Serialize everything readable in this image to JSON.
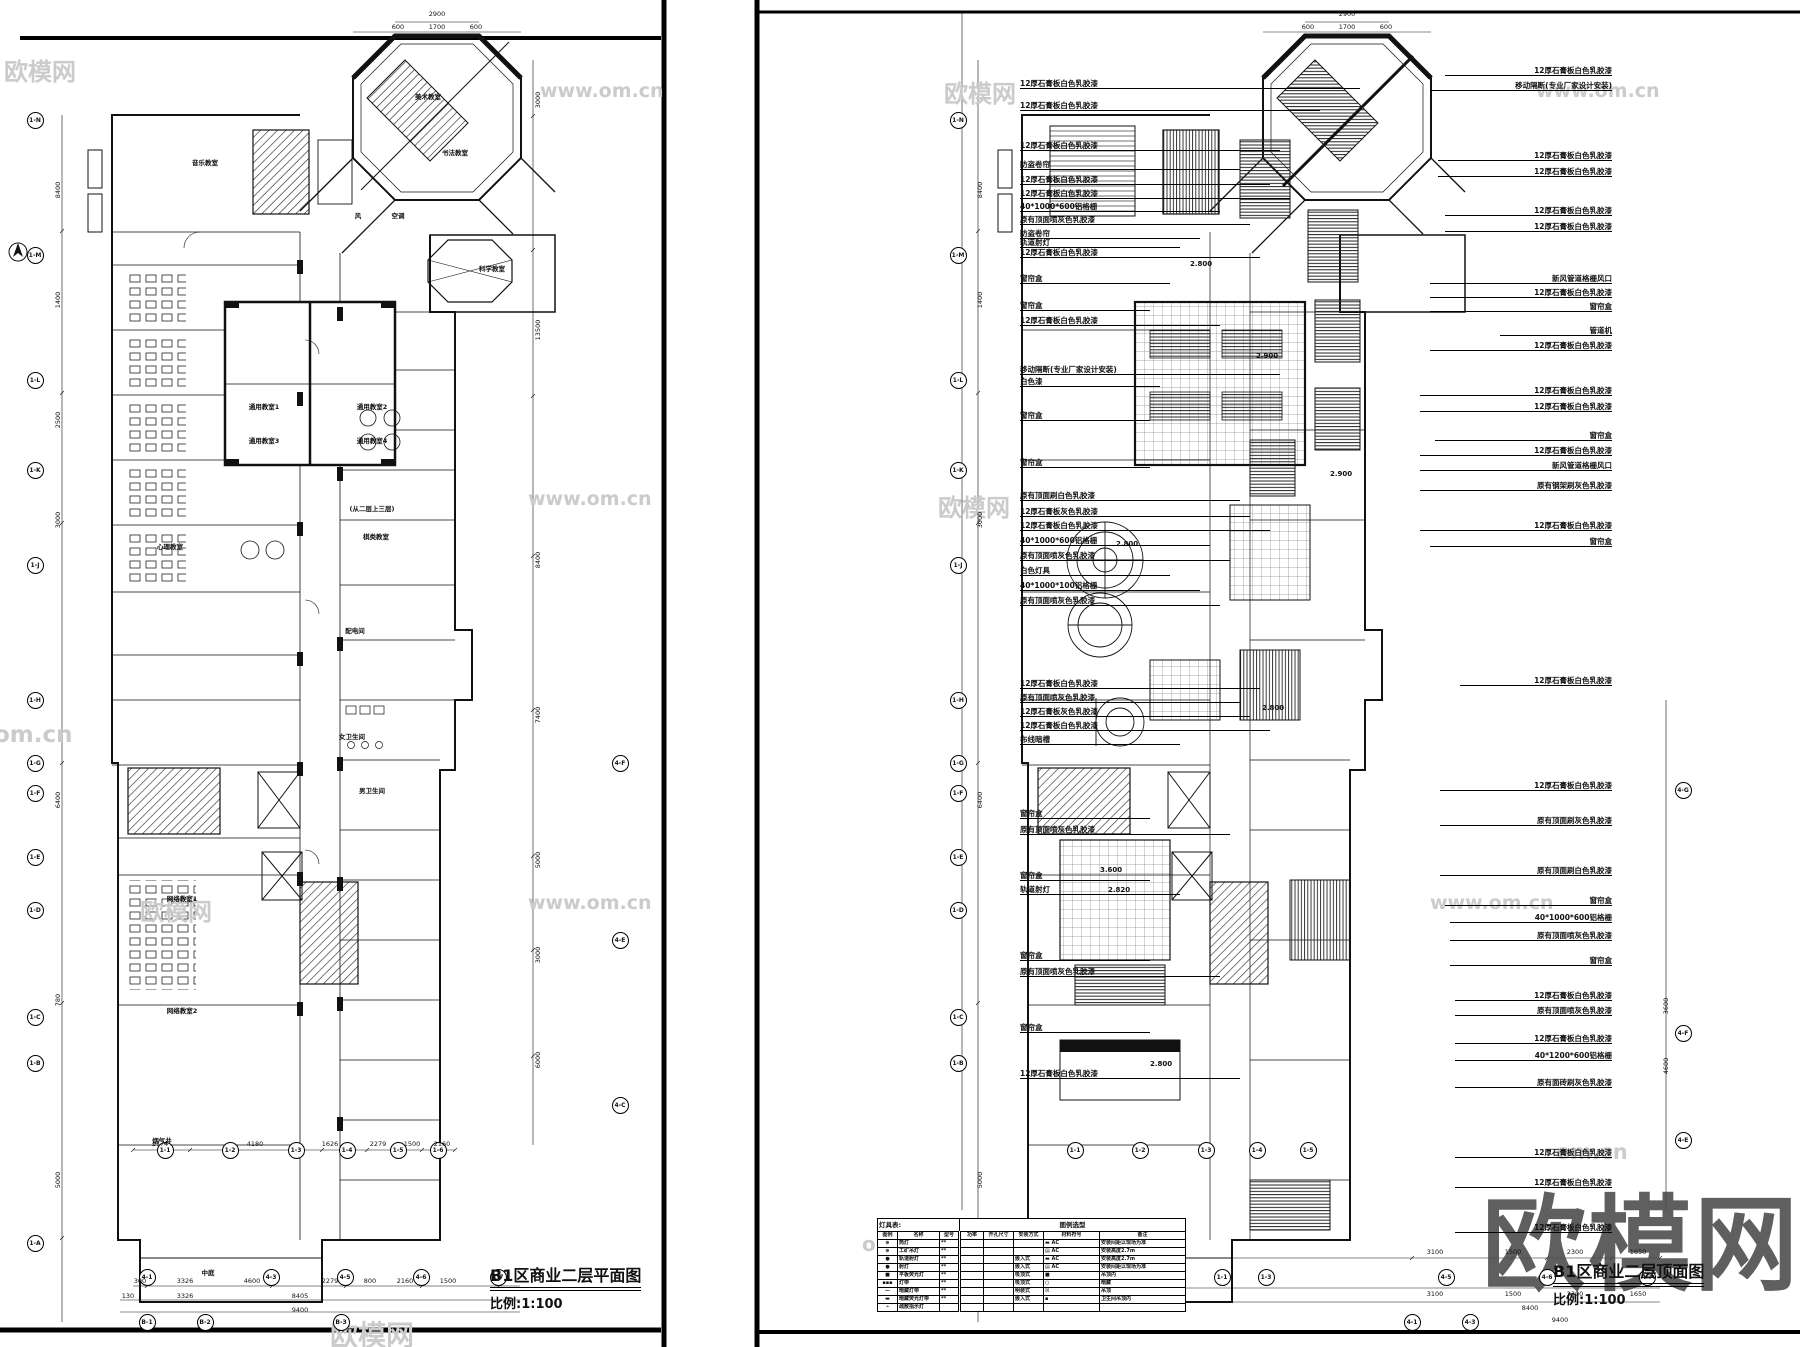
{
  "sheets": {
    "left": {
      "title": "B1区商业二层平面图",
      "scale": "比例:1:100"
    },
    "right": {
      "title": "B1区商业二层顶面图",
      "scale": "比例:1:100"
    }
  },
  "colors": {
    "line": "#111111",
    "watermark_light": "#cbcbcb",
    "watermark_dark": "#4a4a4a"
  },
  "watermarks": [
    {
      "t": "欧模网",
      "x": 4,
      "y": 52,
      "s": 24,
      "big": false
    },
    {
      "t": "www.om.cn",
      "x": 540,
      "y": 80,
      "s": 19,
      "big": false
    },
    {
      "t": "欧模网",
      "x": 944,
      "y": 74,
      "s": 24,
      "big": false
    },
    {
      "t": "www.om.cn",
      "x": 1536,
      "y": 80,
      "s": 19,
      "big": false
    },
    {
      "t": "www.om.cn",
      "x": 528,
      "y": 488,
      "s": 19,
      "big": false
    },
    {
      "t": "欧模网",
      "x": 938,
      "y": 488,
      "s": 24,
      "big": false
    },
    {
      "t": "om.cn",
      "x": -6,
      "y": 722,
      "s": 23,
      "big": false
    },
    {
      "t": "www.om.cn",
      "x": 528,
      "y": 892,
      "s": 19,
      "big": false
    },
    {
      "t": "欧模网",
      "x": 140,
      "y": 892,
      "s": 24,
      "big": false
    },
    {
      "t": "www.om.cn",
      "x": 1430,
      "y": 892,
      "s": 19,
      "big": false
    },
    {
      "t": "om.cn",
      "x": 1556,
      "y": 1140,
      "s": 21,
      "big": false
    },
    {
      "t": "om.cn",
      "x": 862,
      "y": 1232,
      "s": 20,
      "big": false
    },
    {
      "t": "欧模网",
      "x": 330,
      "y": 1314,
      "s": 28,
      "big": false
    },
    {
      "t": "欧模网",
      "x": 1482,
      "y": 1160,
      "s": 104,
      "big": true
    }
  ],
  "grid_bubbles": [
    {
      "l": "1-N",
      "x": 35,
      "y": 120
    },
    {
      "l": "1-M",
      "x": 35,
      "y": 255
    },
    {
      "l": "1-L",
      "x": 35,
      "y": 380
    },
    {
      "l": "1-K",
      "x": 35,
      "y": 470
    },
    {
      "l": "1-J",
      "x": 35,
      "y": 565
    },
    {
      "l": "1-H",
      "x": 35,
      "y": 700
    },
    {
      "l": "1-G",
      "x": 35,
      "y": 763
    },
    {
      "l": "1-F",
      "x": 35,
      "y": 793
    },
    {
      "l": "1-E",
      "x": 35,
      "y": 857
    },
    {
      "l": "1-D",
      "x": 35,
      "y": 910
    },
    {
      "l": "1-C",
      "x": 35,
      "y": 1017
    },
    {
      "l": "1-B",
      "x": 35,
      "y": 1063
    },
    {
      "l": "1-A",
      "x": 35,
      "y": 1243
    },
    {
      "l": "4-F",
      "x": 620,
      "y": 763
    },
    {
      "l": "4-E",
      "x": 620,
      "y": 940
    },
    {
      "l": "4-C",
      "x": 620,
      "y": 1105
    },
    {
      "l": "1-1",
      "x": 165,
      "y": 1150
    },
    {
      "l": "1-2",
      "x": 230,
      "y": 1150
    },
    {
      "l": "1-3",
      "x": 296,
      "y": 1150
    },
    {
      "l": "1-4",
      "x": 347,
      "y": 1150
    },
    {
      "l": "1-5",
      "x": 398,
      "y": 1150
    },
    {
      "l": "1-6",
      "x": 438,
      "y": 1150
    },
    {
      "l": "4-1",
      "x": 147,
      "y": 1277
    },
    {
      "l": "4-3",
      "x": 271,
      "y": 1277
    },
    {
      "l": "4-5",
      "x": 345,
      "y": 1277
    },
    {
      "l": "4-6",
      "x": 421,
      "y": 1277
    },
    {
      "l": "1-7",
      "x": 498,
      "y": 1277
    },
    {
      "l": "B-1",
      "x": 147,
      "y": 1322
    },
    {
      "l": "B-2",
      "x": 205,
      "y": 1322
    },
    {
      "l": "B-3",
      "x": 341,
      "y": 1322
    },
    {
      "l": "1-N",
      "x": 958,
      "y": 120
    },
    {
      "l": "1-M",
      "x": 958,
      "y": 255
    },
    {
      "l": "1-L",
      "x": 958,
      "y": 380
    },
    {
      "l": "1-K",
      "x": 958,
      "y": 470
    },
    {
      "l": "1-J",
      "x": 958,
      "y": 565
    },
    {
      "l": "1-H",
      "x": 958,
      "y": 700
    },
    {
      "l": "1-G",
      "x": 958,
      "y": 763
    },
    {
      "l": "1-F",
      "x": 958,
      "y": 793
    },
    {
      "l": "1-E",
      "x": 958,
      "y": 857
    },
    {
      "l": "1-D",
      "x": 958,
      "y": 910
    },
    {
      "l": "1-C",
      "x": 958,
      "y": 1017
    },
    {
      "l": "1-B",
      "x": 958,
      "y": 1063
    },
    {
      "l": "1-A",
      "x": 958,
      "y": 1243
    },
    {
      "l": "4-G",
      "x": 1683,
      "y": 790
    },
    {
      "l": "4-F",
      "x": 1683,
      "y": 1033
    },
    {
      "l": "4-E",
      "x": 1683,
      "y": 1140
    },
    {
      "l": "1-1",
      "x": 1075,
      "y": 1150
    },
    {
      "l": "1-2",
      "x": 1140,
      "y": 1150
    },
    {
      "l": "1-3",
      "x": 1206,
      "y": 1150
    },
    {
      "l": "1-4",
      "x": 1257,
      "y": 1150
    },
    {
      "l": "1-5",
      "x": 1308,
      "y": 1150
    },
    {
      "l": "1-1",
      "x": 1222,
      "y": 1277
    },
    {
      "l": "1-3",
      "x": 1266,
      "y": 1277
    },
    {
      "l": "4-5",
      "x": 1446,
      "y": 1277
    },
    {
      "l": "4-6",
      "x": 1547,
      "y": 1277
    },
    {
      "l": "4-7",
      "x": 1647,
      "y": 1277
    },
    {
      "l": "4-1",
      "x": 1412,
      "y": 1322
    },
    {
      "l": "4-3",
      "x": 1470,
      "y": 1322
    }
  ],
  "dimensions": [
    {
      "t": "3000",
      "x": 538,
      "y": 100,
      "v": true
    },
    {
      "t": "13500",
      "x": 538,
      "y": 330,
      "v": true
    },
    {
      "t": "8400",
      "x": 538,
      "y": 560,
      "v": true
    },
    {
      "t": "7400",
      "x": 538,
      "y": 715,
      "v": true
    },
    {
      "t": "5000",
      "x": 538,
      "y": 860,
      "v": true
    },
    {
      "t": "3000",
      "x": 538,
      "y": 955,
      "v": true
    },
    {
      "t": "6000",
      "x": 538,
      "y": 1060,
      "v": true
    },
    {
      "t": "8400",
      "x": 58,
      "y": 190,
      "v": true
    },
    {
      "t": "1400",
      "x": 58,
      "y": 300,
      "v": true
    },
    {
      "t": "2500",
      "x": 58,
      "y": 420,
      "v": true
    },
    {
      "t": "3000",
      "x": 58,
      "y": 520,
      "v": true
    },
    {
      "t": "6400",
      "x": 58,
      "y": 800,
      "v": true
    },
    {
      "t": "780",
      "x": 58,
      "y": 1000,
      "v": true
    },
    {
      "t": "5000",
      "x": 58,
      "y": 1180,
      "v": true
    },
    {
      "t": "2900",
      "x": 437,
      "y": 14,
      "v": false
    },
    {
      "t": "600",
      "x": 398,
      "y": 27,
      "v": false
    },
    {
      "t": "1700",
      "x": 437,
      "y": 27,
      "v": false
    },
    {
      "t": "600",
      "x": 476,
      "y": 27,
      "v": false
    },
    {
      "t": "1774",
      "x": 160,
      "y": 1144,
      "v": false
    },
    {
      "t": "4180",
      "x": 255,
      "y": 1144,
      "v": false
    },
    {
      "t": "1626",
      "x": 330,
      "y": 1144,
      "v": false
    },
    {
      "t": "2279",
      "x": 378,
      "y": 1144,
      "v": false
    },
    {
      "t": "1500",
      "x": 412,
      "y": 1144,
      "v": false
    },
    {
      "t": "2160",
      "x": 442,
      "y": 1144,
      "v": false
    },
    {
      "t": "300",
      "x": 140,
      "y": 1281,
      "v": false
    },
    {
      "t": "3326",
      "x": 185,
      "y": 1281,
      "v": false
    },
    {
      "t": "4600",
      "x": 252,
      "y": 1281,
      "v": false
    },
    {
      "t": "2279",
      "x": 330,
      "y": 1281,
      "v": false
    },
    {
      "t": "800",
      "x": 370,
      "y": 1281,
      "v": false
    },
    {
      "t": "2160",
      "x": 405,
      "y": 1281,
      "v": false
    },
    {
      "t": "1500",
      "x": 448,
      "y": 1281,
      "v": false
    },
    {
      "t": "130",
      "x": 128,
      "y": 1296,
      "v": false
    },
    {
      "t": "3326",
      "x": 185,
      "y": 1296,
      "v": false
    },
    {
      "t": "8405",
      "x": 300,
      "y": 1296,
      "v": false
    },
    {
      "t": "9400",
      "x": 300,
      "y": 1310,
      "v": false
    },
    {
      "t": "2900",
      "x": 1347,
      "y": 14,
      "v": false
    },
    {
      "t": "600",
      "x": 1308,
      "y": 27,
      "v": false
    },
    {
      "t": "1700",
      "x": 1347,
      "y": 27,
      "v": false
    },
    {
      "t": "600",
      "x": 1386,
      "y": 27,
      "v": false
    },
    {
      "t": "8400",
      "x": 980,
      "y": 190,
      "v": true
    },
    {
      "t": "1400",
      "x": 980,
      "y": 300,
      "v": true
    },
    {
      "t": "3000",
      "x": 980,
      "y": 520,
      "v": true
    },
    {
      "t": "6400",
      "x": 980,
      "y": 800,
      "v": true
    },
    {
      "t": "5000",
      "x": 980,
      "y": 1180,
      "v": true
    },
    {
      "t": "3600",
      "x": 1666,
      "y": 1006,
      "v": true
    },
    {
      "t": "4600",
      "x": 1666,
      "y": 1066,
      "v": true
    },
    {
      "t": "3100",
      "x": 1435,
      "y": 1252,
      "v": false
    },
    {
      "t": "1500",
      "x": 1513,
      "y": 1252,
      "v": false
    },
    {
      "t": "2300",
      "x": 1575,
      "y": 1252,
      "v": false
    },
    {
      "t": "1650",
      "x": 1638,
      "y": 1252,
      "v": false
    },
    {
      "t": "3100",
      "x": 1435,
      "y": 1294,
      "v": false
    },
    {
      "t": "1500",
      "x": 1513,
      "y": 1294,
      "v": false
    },
    {
      "t": "2300",
      "x": 1575,
      "y": 1294,
      "v": false
    },
    {
      "t": "1650",
      "x": 1638,
      "y": 1294,
      "v": false
    },
    {
      "t": "8400",
      "x": 1530,
      "y": 1308,
      "v": false
    },
    {
      "t": "9400",
      "x": 1560,
      "y": 1320,
      "v": false
    }
  ],
  "room_labels": [
    {
      "t": "美术教室",
      "x": 428,
      "y": 96
    },
    {
      "t": "书法教室",
      "x": 455,
      "y": 152
    },
    {
      "t": "科学教室",
      "x": 492,
      "y": 268
    },
    {
      "t": "音乐教室",
      "x": 205,
      "y": 162
    },
    {
      "t": "风",
      "x": 358,
      "y": 215
    },
    {
      "t": "空调",
      "x": 398,
      "y": 215
    },
    {
      "t": "通用教室1",
      "x": 264,
      "y": 406
    },
    {
      "t": "通用教室2",
      "x": 372,
      "y": 406
    },
    {
      "t": "通用教室3",
      "x": 264,
      "y": 440
    },
    {
      "t": "通用教室4",
      "x": 372,
      "y": 440
    },
    {
      "t": "棋类教室",
      "x": 376,
      "y": 536
    },
    {
      "t": "心理教室",
      "x": 170,
      "y": 546
    },
    {
      "t": "(从二层上三层)",
      "x": 372,
      "y": 508
    },
    {
      "t": "配电间",
      "x": 355,
      "y": 630
    },
    {
      "t": "女卫生间",
      "x": 352,
      "y": 736
    },
    {
      "t": "男卫生间",
      "x": 372,
      "y": 790
    },
    {
      "t": "网络教室1",
      "x": 182,
      "y": 898
    },
    {
      "t": "网络教室2",
      "x": 182,
      "y": 1010
    },
    {
      "t": "烟气井",
      "x": 162,
      "y": 1140
    },
    {
      "t": "中庭",
      "x": 208,
      "y": 1272
    }
  ],
  "ceiling_heights": [
    {
      "t": "2.800",
      "x": 1190,
      "y": 260
    },
    {
      "t": "2.900",
      "x": 1256,
      "y": 352
    },
    {
      "t": "2.800",
      "x": 1116,
      "y": 540
    },
    {
      "t": "2.900",
      "x": 1330,
      "y": 470
    },
    {
      "t": "2.800",
      "x": 1262,
      "y": 704
    },
    {
      "t": "3.600",
      "x": 1100,
      "y": 866
    },
    {
      "t": "2.820",
      "x": 1108,
      "y": 886
    },
    {
      "t": "2.800",
      "x": 1150,
      "y": 1060
    }
  ],
  "annotations_left": [
    {
      "t": "12厚石膏板白色乳胶漆",
      "y": 88,
      "w": 340
    },
    {
      "t": "12厚石膏板白色乳胶漆",
      "y": 110,
      "w": 300
    },
    {
      "t": "12厚石膏板白色乳胶漆",
      "y": 150,
      "w": 260
    },
    {
      "t": "防盗卷帘",
      "y": 169,
      "w": 220
    },
    {
      "t": "12厚石膏板白色乳胶漆",
      "y": 184,
      "w": 250
    },
    {
      "t": "12厚石膏板白色乳胶漆",
      "y": 198,
      "w": 270
    },
    {
      "t": "40*1000*600铝格栅",
      "y": 211,
      "w": 200
    },
    {
      "t": "原有顶面喷灰色乳胶漆",
      "y": 224,
      "w": 230
    },
    {
      "t": "防盗卷帘",
      "y": 238,
      "w": 180
    },
    {
      "t": "轨道射灯",
      "y": 247,
      "w": 160
    },
    {
      "t": "12厚石膏板白色乳胶漆",
      "y": 257,
      "w": 240
    },
    {
      "t": "窗帘盒",
      "y": 283,
      "w": 150
    },
    {
      "t": "窗帘盒",
      "y": 310,
      "w": 130
    },
    {
      "t": "12厚石膏板白色乳胶漆",
      "y": 325,
      "w": 200
    },
    {
      "t": "移动隔断(专业厂家设计安装)",
      "y": 374,
      "w": 260
    },
    {
      "t": "白色漆",
      "y": 386,
      "w": 140
    },
    {
      "t": "窗帘盒",
      "y": 420,
      "w": 130
    },
    {
      "t": "窗帘盒",
      "y": 467,
      "w": 130
    },
    {
      "t": "原有顶面刷白色乳胶漆",
      "y": 500,
      "w": 220
    },
    {
      "t": "12厚石膏板灰色乳胶漆",
      "y": 516,
      "w": 230
    },
    {
      "t": "12厚石膏板白色乳胶漆",
      "y": 530,
      "w": 250
    },
    {
      "t": "40*1000*600铝格栅",
      "y": 545,
      "w": 190
    },
    {
      "t": "原有顶面喷灰色乳胶漆",
      "y": 560,
      "w": 210
    },
    {
      "t": "白色灯具",
      "y": 575,
      "w": 150
    },
    {
      "t": "40*1000*100铝格栅",
      "y": 590,
      "w": 180
    },
    {
      "t": "原有顶面喷灰色乳胶漆",
      "y": 605,
      "w": 200
    },
    {
      "t": "12厚石膏板白色乳胶漆",
      "y": 688,
      "w": 240
    },
    {
      "t": "原有顶面喷灰色乳胶漆",
      "y": 702,
      "w": 220
    },
    {
      "t": "12厚石膏板灰色乳胶漆",
      "y": 716,
      "w": 230
    },
    {
      "t": "12厚石膏板白色乳胶漆",
      "y": 730,
      "w": 250
    },
    {
      "t": "布线暗槽",
      "y": 744,
      "w": 160
    },
    {
      "t": "窗帘盒",
      "y": 818,
      "w": 130
    },
    {
      "t": "原有顶面喷灰色乳胶漆",
      "y": 834,
      "w": 210
    },
    {
      "t": "窗帘盒",
      "y": 880,
      "w": 130
    },
    {
      "t": "轨道射灯",
      "y": 894,
      "w": 160
    },
    {
      "t": "窗帘盒",
      "y": 960,
      "w": 130
    },
    {
      "t": "原有顶面喷灰色乳胶漆",
      "y": 976,
      "w": 200
    },
    {
      "t": "窗帘盒",
      "y": 1032,
      "w": 130
    },
    {
      "t": "12厚石膏板白色乳胶漆",
      "y": 1078,
      "w": 220
    }
  ],
  "annotations_right": [
    {
      "t": "12厚石膏板白色乳胶漆",
      "x": 1445,
      "y": 75
    },
    {
      "t": "移动隔断(专业厂家设计安装)",
      "x": 1430,
      "y": 90
    },
    {
      "t": "12厚石膏板白色乳胶漆",
      "x": 1438,
      "y": 160
    },
    {
      "t": "12厚石膏板白色乳胶漆",
      "x": 1438,
      "y": 176
    },
    {
      "t": "12厚石膏板白色乳胶漆",
      "x": 1445,
      "y": 215
    },
    {
      "t": "12厚石膏板白色乳胶漆",
      "x": 1445,
      "y": 231
    },
    {
      "t": "新风管道格栅风口",
      "x": 1430,
      "y": 283
    },
    {
      "t": "12厚石膏板白色乳胶漆",
      "x": 1430,
      "y": 297
    },
    {
      "t": "窗帘盒",
      "x": 1430,
      "y": 311
    },
    {
      "t": "管道机",
      "x": 1500,
      "y": 335
    },
    {
      "t": "12厚石膏板白色乳胶漆",
      "x": 1430,
      "y": 350
    },
    {
      "t": "12厚石膏板白色乳胶漆",
      "x": 1420,
      "y": 395
    },
    {
      "t": "12厚石膏板白色乳胶漆",
      "x": 1420,
      "y": 411
    },
    {
      "t": "窗帘盒",
      "x": 1435,
      "y": 440
    },
    {
      "t": "12厚石膏板白色乳胶漆",
      "x": 1420,
      "y": 455
    },
    {
      "t": "新风管道格栅风口",
      "x": 1420,
      "y": 470
    },
    {
      "t": "原有钢架刷灰色乳胶漆",
      "x": 1420,
      "y": 490
    },
    {
      "t": "12厚石膏板白色乳胶漆",
      "x": 1420,
      "y": 530
    },
    {
      "t": "窗帘盒",
      "x": 1430,
      "y": 546
    },
    {
      "t": "12厚石膏板白色乳胶漆",
      "x": 1460,
      "y": 685
    },
    {
      "t": "12厚石膏板白色乳胶漆",
      "x": 1440,
      "y": 790
    },
    {
      "t": "原有顶面刷灰色乳胶漆",
      "x": 1440,
      "y": 825
    },
    {
      "t": "原有顶面刷白色乳胶漆",
      "x": 1440,
      "y": 875
    },
    {
      "t": "窗帘盒",
      "x": 1445,
      "y": 905
    },
    {
      "t": "40*1000*600铝格栅",
      "x": 1450,
      "y": 922
    },
    {
      "t": "原有顶面喷灰色乳胶漆",
      "x": 1450,
      "y": 940
    },
    {
      "t": "窗帘盒",
      "x": 1450,
      "y": 965
    },
    {
      "t": "12厚石膏板白色乳胶漆",
      "x": 1455,
      "y": 1000
    },
    {
      "t": "原有顶面喷灰色乳胶漆",
      "x": 1455,
      "y": 1015
    },
    {
      "t": "12厚石膏板白色乳胶漆",
      "x": 1455,
      "y": 1043
    },
    {
      "t": "40*1200*600铝格栅",
      "x": 1455,
      "y": 1060
    },
    {
      "t": "原有面砖刷灰色乳胶漆",
      "x": 1455,
      "y": 1087
    },
    {
      "t": "12厚石膏板白色乳胶漆",
      "x": 1455,
      "y": 1157
    },
    {
      "t": "12厚石膏板白色乳胶漆",
      "x": 1455,
      "y": 1187
    },
    {
      "t": "12厚石膏板白色乳胶漆",
      "x": 1455,
      "y": 1232
    }
  ],
  "legend": {
    "title": "灯具表:",
    "subtitle": "图例选型",
    "headers": [
      "图例",
      "名称",
      "型号",
      "功率",
      "开孔尺寸",
      "安装方式",
      "材料符号",
      "备注"
    ],
    "rows": [
      {
        "icon": "⊕",
        "name": "筒灯",
        "model": "**",
        "power": "",
        "hole": "",
        "install": "",
        "material": "▬ AC",
        "remark": "安装间距以现场为准"
      },
      {
        "icon": "⊕",
        "name": "工矿吊灯",
        "model": "**",
        "power": "",
        "hole": "",
        "install": "",
        "material": "▤ AC",
        "remark": "安装高度2.7m"
      },
      {
        "icon": "●",
        "name": "轨道射灯",
        "model": "**",
        "power": "",
        "hole": "",
        "install": "嵌入式",
        "material": "▬ AC",
        "remark": "安装高度2.7m"
      },
      {
        "icon": "●",
        "name": "射灯",
        "model": "**",
        "power": "",
        "hole": "",
        "install": "嵌入式",
        "material": "▤ AC",
        "remark": "安装间距以现场为准"
      },
      {
        "icon": "■",
        "name": "平板荧光灯",
        "model": "**",
        "power": "",
        "hole": "",
        "install": "吸顶式",
        "material": "■",
        "remark": "吊顶内"
      },
      {
        "icon": "▪▪▪",
        "name": "灯带",
        "model": "**",
        "power": "",
        "hole": "",
        "install": "吸顶式",
        "material": "○",
        "remark": "暗藏"
      },
      {
        "icon": "—",
        "name": "暗藏灯带",
        "model": "**",
        "power": "",
        "hole": "",
        "install": "明装式",
        "material": "☒",
        "remark": "吊顶"
      },
      {
        "icon": "▬",
        "name": "暗藏荧光灯带",
        "model": "**",
        "power": "",
        "hole": "",
        "install": "嵌入式",
        "material": "▪",
        "remark": "卫生间吊顶内"
      },
      {
        "icon": "➛",
        "name": "疏散指示灯",
        "model": "",
        "power": "",
        "hole": "",
        "install": "",
        "material": "",
        "remark": ""
      }
    ]
  }
}
